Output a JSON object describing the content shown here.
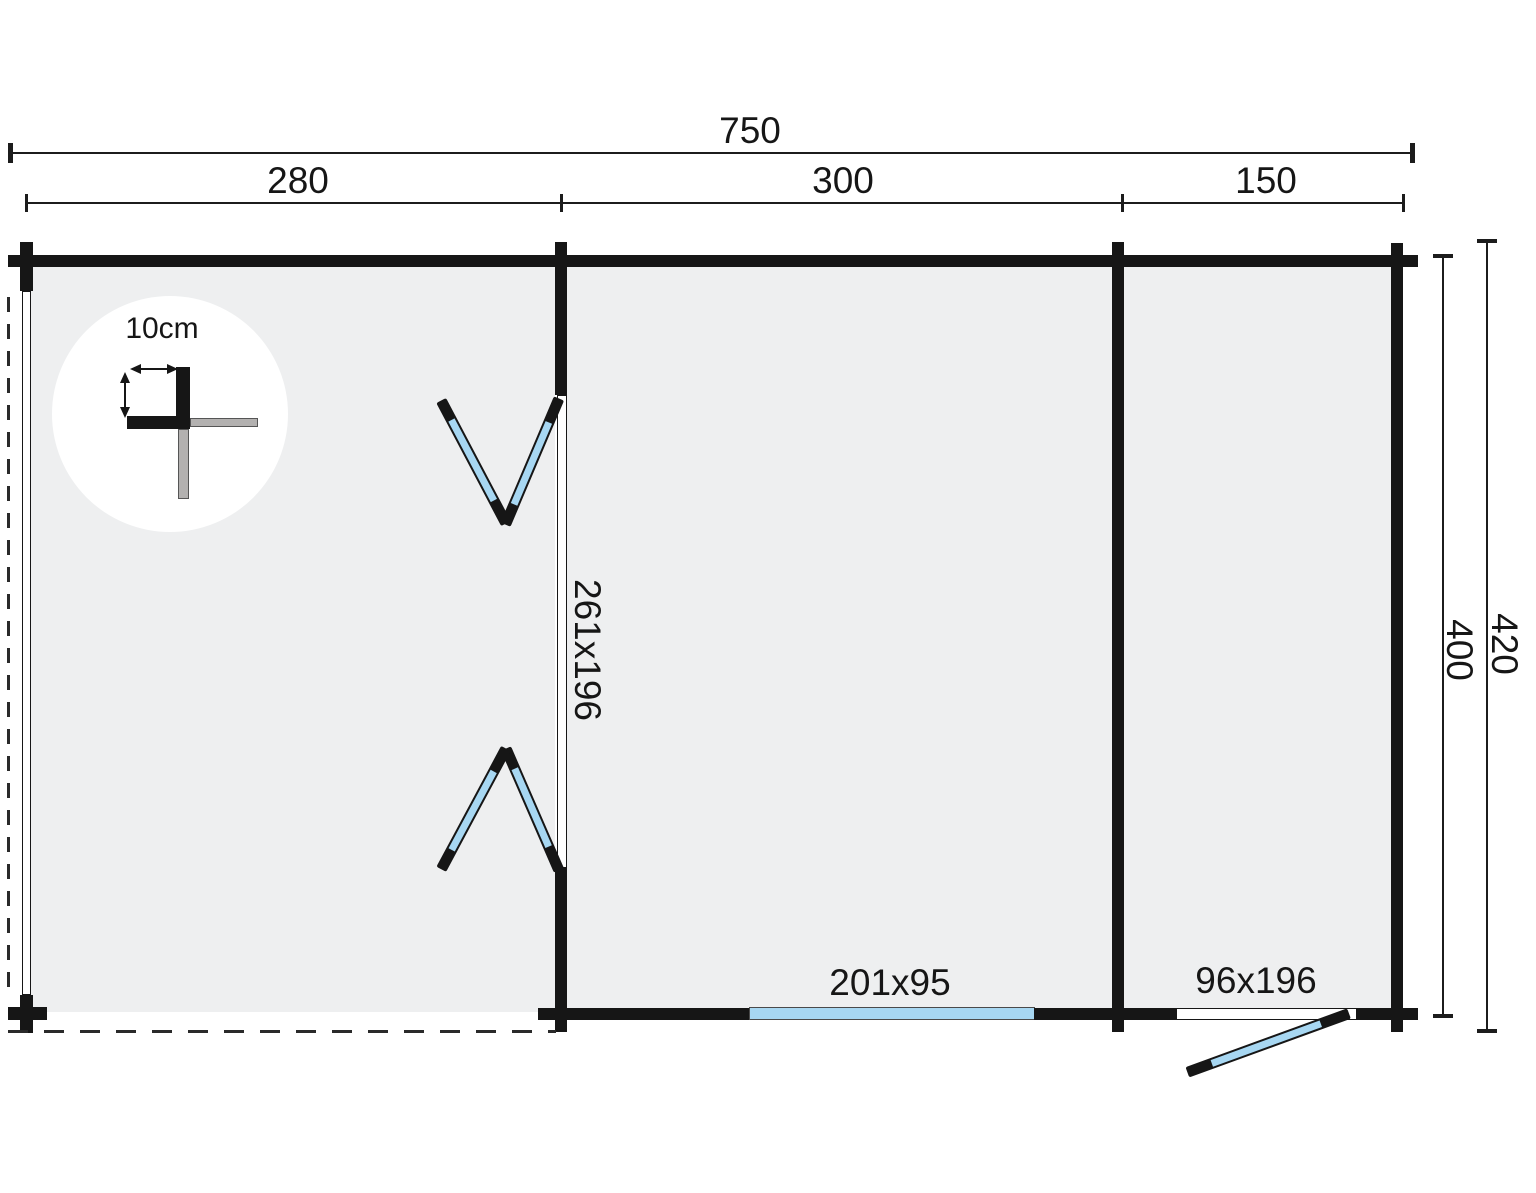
{
  "dimensions": {
    "total_width": "750",
    "section_1": "280",
    "section_2": "300",
    "section_3": "150",
    "depth_inner": "400",
    "depth_overall": "420"
  },
  "openings": {
    "double_door": "261x196",
    "window": "201x95",
    "side_door": "96x196"
  },
  "detail": {
    "wall_thickness": "10cm"
  },
  "colors": {
    "wall": "#161616",
    "floor": "#eeeff0",
    "glass_blue": "#a7d7f2",
    "detail_grey": "#b3b1b0",
    "background": "#ffffff"
  }
}
